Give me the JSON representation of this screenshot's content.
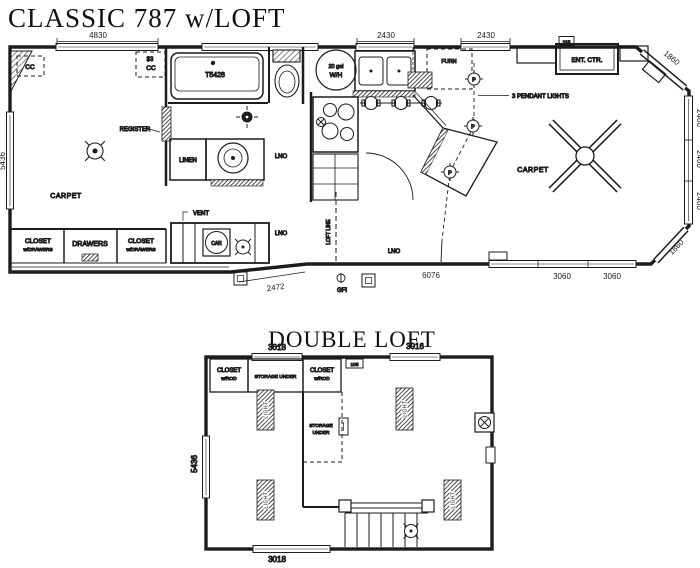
{
  "main_plan": {
    "title": "CLASSIC 787 w/LOFT",
    "dimensions": {
      "top_window": "4830",
      "kitchen_window_1": "2430",
      "kitchen_window_2": "2430",
      "left_wall": "5436",
      "right_chamfer_top": "1860",
      "right_window_1": "2460",
      "right_window_2": "2460",
      "right_window_3": "2460",
      "right_chamfer_bottom": "1860",
      "entry_wall": "2472",
      "bottom_wall": "6076",
      "bottom_window_1": "3060",
      "bottom_window_2": "3060"
    },
    "labels": {
      "overhead_cabinet_left": "CC",
      "overhead_cabinet_right_line1": "$3",
      "overhead_cabinet_right_line2": "CC",
      "register": "REGISTER",
      "bedroom_floor": "CARPET",
      "closet_line1": "CLOSET",
      "closet_line2": "w/DRAWERS",
      "drawers": "DRAWERS",
      "tub": "T5428",
      "linen": "LINEN",
      "bath_floor": "LNO",
      "vent": "VENT",
      "detector": "CAR",
      "hall_floor": "LNO",
      "loft_line": "LOFT LINE",
      "gfi": "GFI",
      "water_heater_line1": "20 gal",
      "water_heater_line2": "W/H",
      "furnace": "FURN",
      "kitchen_floor": "LNO",
      "pendant_symbol": "P",
      "pendant_note": "3 PENDANT LIGHTS",
      "entertainment_center": "ENT. CTR.",
      "tv_outlet": "115",
      "living_floor": "CARPET"
    }
  },
  "loft_plan": {
    "title": "DOUBLE LOFT",
    "dimensions": {
      "top_window_left": "3018",
      "top_window_right": "3016",
      "left_wall": "5436",
      "bottom_window": "3018"
    },
    "labels": {
      "closet_line1": "CLOSET",
      "closet_line2": "w/ROD",
      "storage_under": "STORAGE UNDER",
      "access_panel": "105",
      "storage_line1": "STORAGE",
      "storage_line2": "UNDER",
      "light": "LIGHT"
    }
  }
}
